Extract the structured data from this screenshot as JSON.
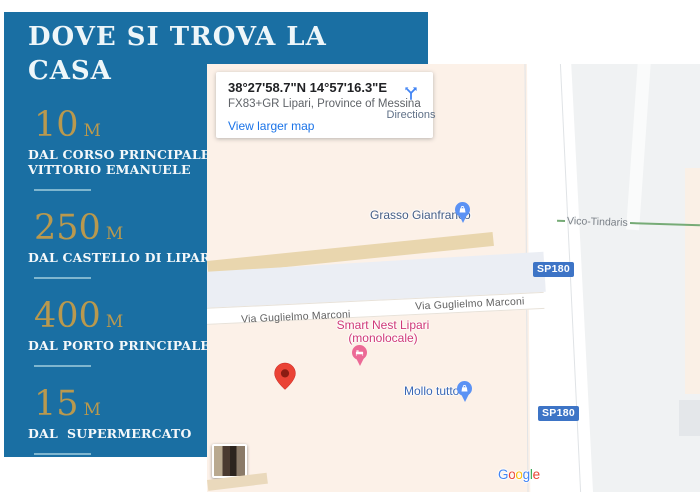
{
  "info_panel": {
    "title_line1": "DOVE SI TROVA LA",
    "title_line2": "CASA",
    "items": [
      {
        "value": "10",
        "unit": "M",
        "label_lines": [
          "DAL CORSO PRINCIPALE",
          "VITTORIO EMANUELE"
        ]
      },
      {
        "value": "250",
        "unit": "M",
        "label_lines": [
          "DAL CASTELLO DI LIPARI"
        ]
      },
      {
        "value": "400",
        "unit": "M",
        "label_lines": [
          "DAL PORTO PRINCIPALE"
        ]
      },
      {
        "value": "15",
        "unit": "M",
        "label_lines": [
          "DAL  SUPERMERCATO"
        ]
      }
    ]
  },
  "map": {
    "card": {
      "coordinates": "38°27'58.7\"N 14°57'16.3\"E",
      "address": "FX83+GR Lipari, Province of Messina",
      "directions_label": "Directions",
      "view_larger_label": "View larger map"
    },
    "labels": {
      "poi_grasso": "Grasso Gianfranco",
      "via_guglielmo_marconi": "Via Guglielmo Marconi",
      "lodging_line1": "Smart Nest Lipari",
      "lodging_line2": "(monolocale)",
      "poi_mollo": "Mollo tutto",
      "route_badge": "SP180",
      "vico_tindaris": "Vico-Tindaris"
    },
    "google_letters": [
      "G",
      "o",
      "o",
      "g",
      "l",
      "e"
    ]
  },
  "colors": {
    "panel_blue": "#1a6fa3",
    "accent_gold": "#b9994e",
    "divider_blue": "#7fb6cf",
    "badge_blue": "#3d74c6",
    "lodging_pink": "#cf3877",
    "poi_pin_blue": "#5b92f4",
    "lodging_pin_pink": "#ec6a96",
    "marker_red": "#ea4335",
    "map_cream": "#fcf1e8",
    "tan_road": "#e9d6ae",
    "link_blue": "#1a73e8"
  }
}
